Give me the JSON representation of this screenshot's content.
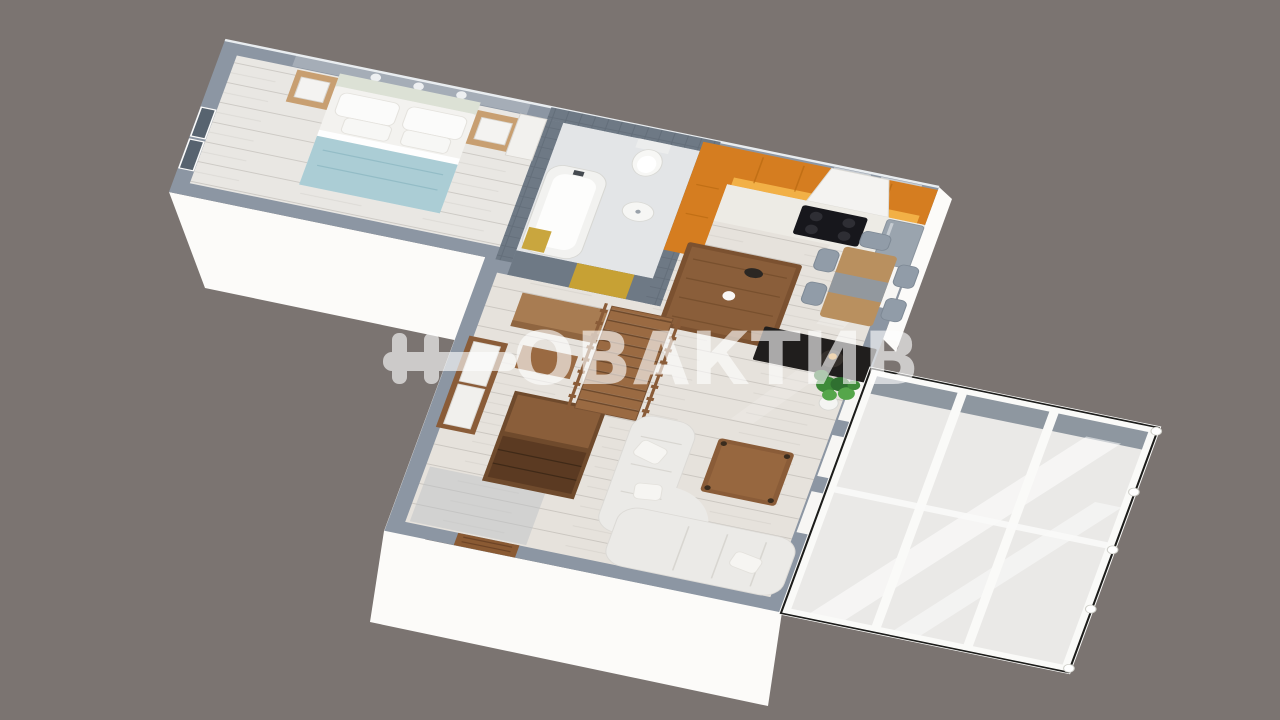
{
  "scene": {
    "title": "apartment-3d-floor-plan-render",
    "background_color": "#7b7471"
  },
  "watermark": {
    "brand": "НОВАКТИВ",
    "wordmark_tail": "ОВАКТИВ",
    "color": "#ffffff",
    "opacity": "0.62"
  },
  "palette": {
    "background": "#7b7471",
    "wall_top": "#8c96a3",
    "wall_bathroom": "#6e7985",
    "wall_exterior_white": "#fcfbf9",
    "floor_wood": "#e6e2dc",
    "floor_bedroom": "#e9e7e3",
    "floor_bathroom": "#e3e5e7",
    "cabinet_orange": "#d57d20",
    "cabinet_glow": "#f7b84e",
    "blanket_teal": "#abcdd5",
    "door_yellow": "#c7a134",
    "wood_light": "#c89f71",
    "wood_mid": "#9a6a42",
    "wood_dark": "#7b5130",
    "wood_table": "#b9905f",
    "sofa_white": "#ebeae7",
    "chair_gray": "#919ca8",
    "tv_black": "#201e1d",
    "plant_green": "#3e8b39",
    "glass": "#f3f3f1",
    "entry_door_brown": "#8a5a33"
  },
  "rooms": [
    {
      "name": "bedroom",
      "furniture": [
        "double-bed",
        "nightstand-left",
        "nightstand-right",
        "window",
        "wardrobe-panel"
      ]
    },
    {
      "name": "bathroom",
      "furniture": [
        "bathtub",
        "toilet",
        "sink",
        "yellow-door",
        "bath-mat"
      ]
    },
    {
      "name": "kitchen",
      "furniture": [
        "orange-cabinets",
        "range-hood",
        "cooktop",
        "counter",
        "fridge",
        "island"
      ]
    },
    {
      "name": "dining-area",
      "furniture": [
        "dining-table",
        "chairs"
      ]
    },
    {
      "name": "hallway",
      "furniture": [
        "wardrobe",
        "console-table",
        "bench",
        "dresser",
        "staircase",
        "entrance-door"
      ]
    },
    {
      "name": "living-room",
      "furniture": [
        "corner-sofa",
        "coffee-table",
        "tv-console",
        "potted-plant"
      ]
    },
    {
      "name": "balcony",
      "furniture": [
        "glazing-frames"
      ]
    }
  ]
}
